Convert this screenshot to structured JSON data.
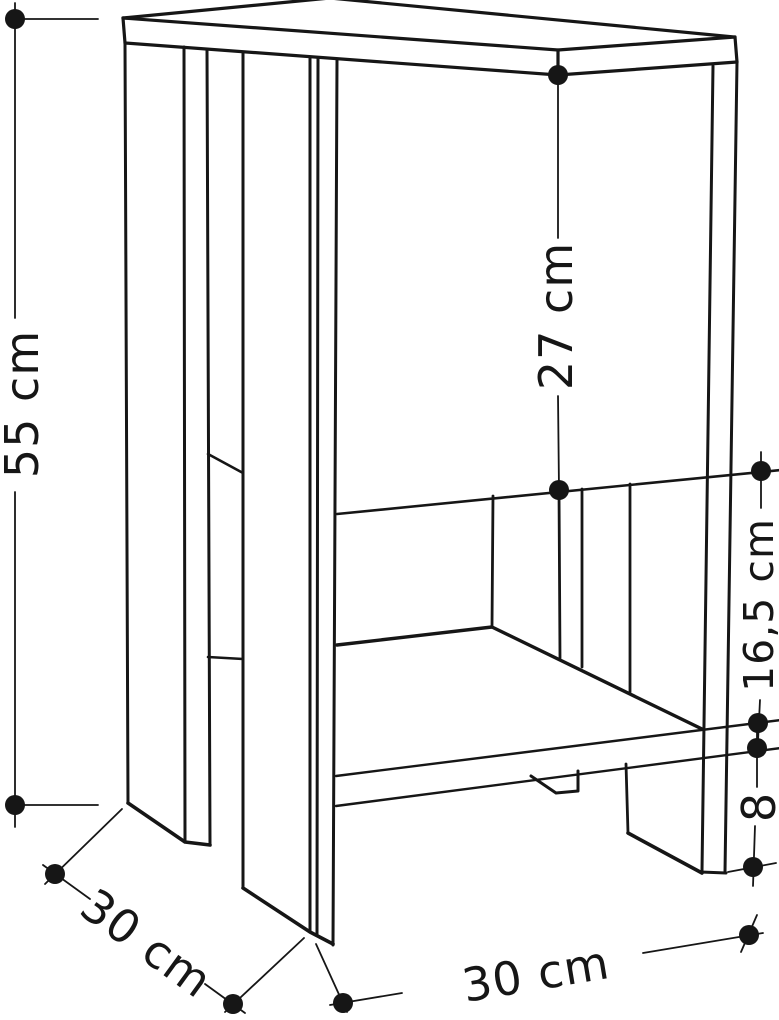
{
  "diagram": {
    "title": "Nightstand dimension drawing",
    "unit": "cm",
    "colors": {
      "line": "#161616",
      "background": "#ffffff"
    },
    "dimensions": {
      "total_height": {
        "label": "55 cm",
        "meaning": "overall height, left side"
      },
      "opening_height": {
        "label": "27 cm",
        "meaning": "upper compartment height"
      },
      "shelf_gap": {
        "label": "16,5 cm",
        "meaning": "open gap between shelves, right side"
      },
      "leg_height": {
        "label": "8",
        "meaning": "leg / plinth height, right side"
      },
      "depth": {
        "label": "30 cm",
        "meaning": "depth, bottom left"
      },
      "width": {
        "label": "30 cm",
        "meaning": "width, bottom right"
      }
    }
  }
}
